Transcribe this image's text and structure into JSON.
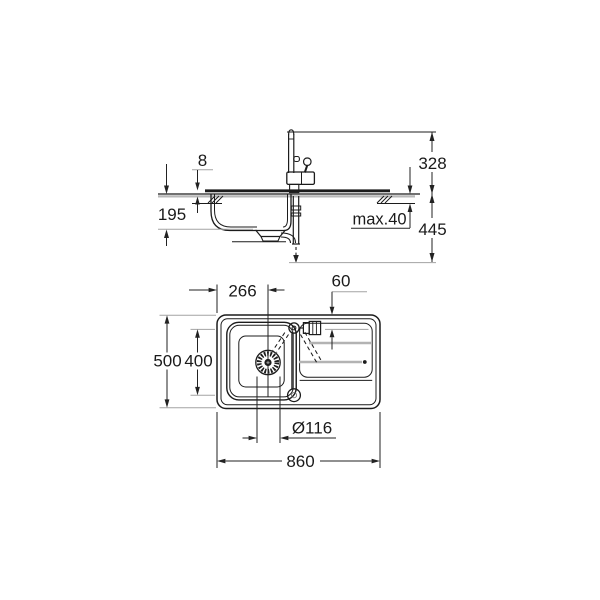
{
  "drawing": {
    "type": "technical-installation-drawing",
    "subject": "kitchen sink with single-lever faucet: side elevation (top) and plan view (bottom)",
    "colors": {
      "line": "#1c1c1c",
      "dimension": "#222222",
      "extension": "#a3a3a3",
      "groove": "#b3b3b3",
      "text": "#1a1a1a",
      "background": "#ffffff"
    },
    "side_view": {
      "labels": {
        "rim_height": "8",
        "bowl_depth": "195",
        "faucet_height": "328",
        "counter_thickness": "max.40",
        "install_depth": "445"
      }
    },
    "plan_view": {
      "labels": {
        "drain_center_from_left": "266",
        "faucet_center_offset": "60",
        "overall_depth": "500",
        "bowl_inner_depth": "400",
        "drain_diameter": "Ø116",
        "overall_length": "860"
      }
    }
  }
}
